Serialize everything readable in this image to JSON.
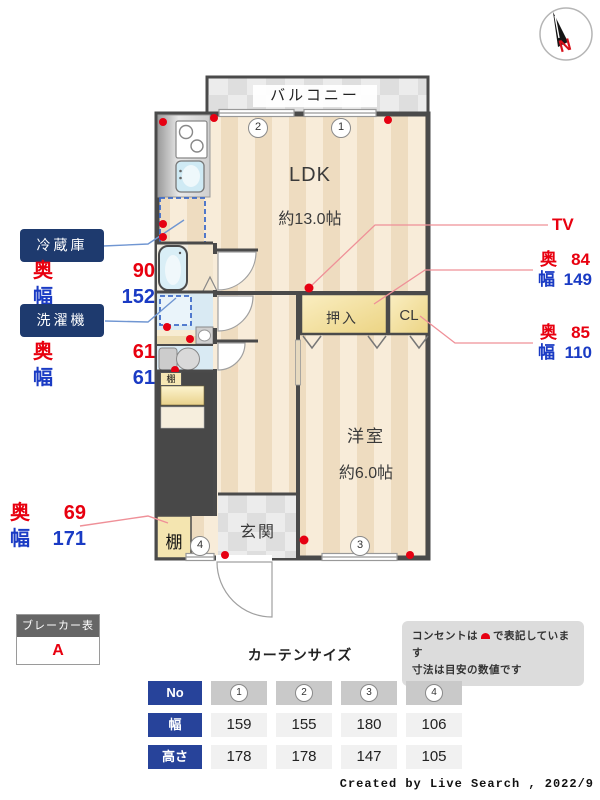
{
  "compass": {
    "north_label": "N"
  },
  "floor_plan": {
    "balcony": "バルコニー",
    "ldk": {
      "name": "LDK",
      "area": "約13.0帖"
    },
    "western_room": {
      "name": "洋室",
      "area": "約6.0帖"
    },
    "closet_oshiire": "押入",
    "closet_cl": "CL",
    "entrance": "玄関",
    "shelf_upper": "棚",
    "shelf_lower": "棚",
    "window_markers": {
      "w1": "1",
      "w2": "2",
      "w3": "3",
      "w4": "4"
    }
  },
  "measurements": {
    "refrigerator": {
      "name": "冷蔵庫",
      "depth_label": "奥",
      "depth": "90",
      "width_label": "幅",
      "width": "152"
    },
    "washer": {
      "name": "洗濯機",
      "depth_label": "奥",
      "depth": "61",
      "width_label": "幅",
      "width": "61"
    },
    "shelf": {
      "depth_label": "奥",
      "depth": "69",
      "width_label": "幅",
      "width": "171"
    },
    "tv": {
      "name": "TV"
    },
    "oshiire_dims": {
      "depth_label": "奥",
      "depth": "84",
      "width_label": "幅",
      "width": "149"
    },
    "cl_dims": {
      "depth_label": "奥",
      "depth": "85",
      "width_label": "幅",
      "width": "110"
    }
  },
  "breaker": {
    "title": "ブレーカー表記",
    "value": "A"
  },
  "notes": {
    "outlet_prefix": "コンセントは",
    "outlet_suffix": "で表記しています",
    "dimension_note": "寸法は目安の数値です"
  },
  "curtain_table": {
    "title": "カーテンサイズ",
    "corner_header": "No",
    "row_width_label": "幅",
    "row_height_label": "高さ",
    "columns": [
      "1",
      "2",
      "3",
      "4"
    ],
    "width_values": [
      "159",
      "155",
      "180",
      "106"
    ],
    "height_values": [
      "178",
      "178",
      "147",
      "105"
    ]
  },
  "credit": "Created by Live Search , 2022/9",
  "colors": {
    "outlet_red": "#e60012",
    "dim_red": "#e8000f",
    "dim_blue": "#1a3bc4",
    "label_navy": "#1e3a6e",
    "table_navy": "#27439a",
    "wall": "#4a4a4a"
  }
}
